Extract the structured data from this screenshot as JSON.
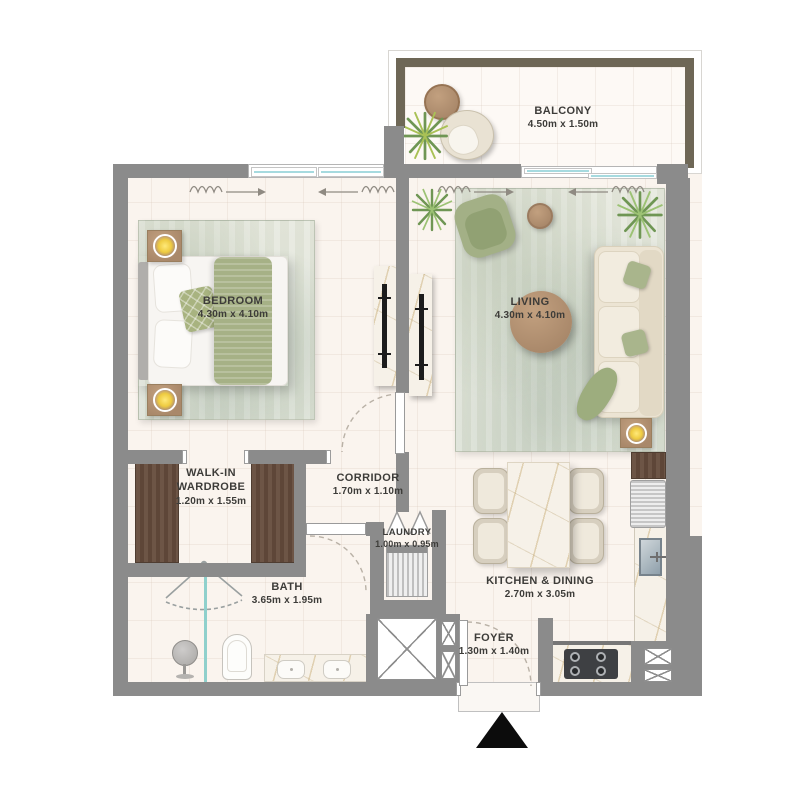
{
  "rooms": {
    "balcony": {
      "name": "BALCONY",
      "dims": "4.50m x 1.50m"
    },
    "bedroom": {
      "name": "BEDROOM",
      "dims": "4.30m x 4.10m"
    },
    "living": {
      "name": "LIVING",
      "dims": "4.30m x 4.10m"
    },
    "wardrobe": {
      "name_line1": "WALK-IN",
      "name_line2": "WARDROBE",
      "dims": "1.20m x 1.55m"
    },
    "corridor": {
      "name": "CORRIDOR",
      "dims": "1.70m x 1.10m"
    },
    "laundry": {
      "name": "LAUNDRY",
      "dims": "1.00m x 0.95m"
    },
    "bath": {
      "name": "BATH",
      "dims": "3.65m x 1.95m"
    },
    "kitchen_dining": {
      "name": "KITCHEN & DINING",
      "dims": "2.70m x 3.05m"
    },
    "foyer": {
      "name": "FOYER",
      "dims": "1.30m x 1.40m"
    }
  },
  "colors": {
    "wall": "#8b8b8b",
    "balcony_wall": "#6e6756",
    "floor": "#faf4ee",
    "rug_green": "#dde1d4",
    "accent_green": "#a7b287",
    "wood": "#b2937a",
    "wardrobe_wood": "#6a5244",
    "lamp_glow": "#f0cc45",
    "glass_blue": "#a6dadf",
    "label_text": "#3d3c39"
  },
  "icons": {
    "north_arrow": "north-arrow",
    "plants": "plant-icon",
    "lamps": "lamp-glow-icon"
  }
}
